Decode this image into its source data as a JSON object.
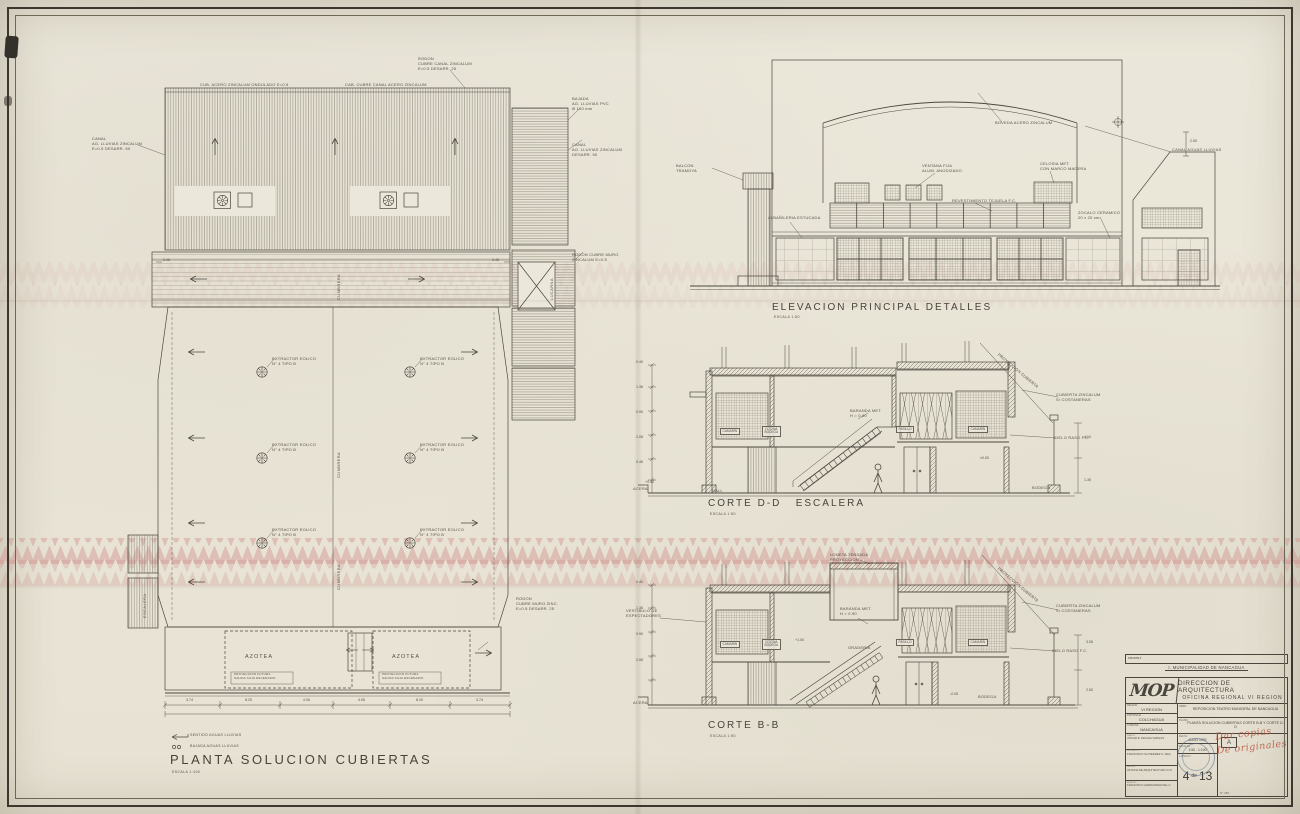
{
  "sheet": {
    "paper": "#eae6d8",
    "ink": "#4c473e",
    "pink": "#cf8d8a",
    "red": "#b5543e"
  },
  "plan": {
    "title": "PLANTA SOLUCION CUBIERTAS",
    "scale": "ESCALA 1:100",
    "legend": [
      {
        "label": "SENTIDO AGUAS LLUVIAS"
      },
      {
        "label": "BAJADA AGUAS LLUVIAS"
      }
    ],
    "notes": {
      "ridge_l": "CUB. ACERO ZINCALUM ONDULADO E=0.5",
      "ridge_r": "CAB. CUBRE CANAL ACERO ZINCALUM",
      "canal_tr": "RODON\nCUBRE CANAL ZINCALUM\nE=0.5 DESARR. 25",
      "canal_l": "CANAL\nAG. LLUVIAS ZINCALUM\nE=0.5 DESARR. 50",
      "canal_r1": "BAJADA\nAG. LLUVIAS PVC\nØ 100 mm",
      "canal_r2": "CANAL\nAG. LLUVIAS ZINCALUM\nDESARR. 50",
      "canal_r3": "RODON CUBRE MURO\nZINCALUM E=0.5",
      "rodon_b": "RODON\nCUBRE MURO ZINC.\nE=0.5 DESARR. 25"
    },
    "vent_note": "EXTRACTOR EOLICO\nN° 4  TIPO B",
    "vertical_ridge": "CUMBRERA",
    "escalera": "ESCALERA",
    "lucarna": "LUCARNA",
    "azotea": "AZOTEA",
    "azotea_note": "PROYECCION FUTURA\nSALIDA CAJA ESCENARIO",
    "dims_band": [
      "2.46",
      "2.46"
    ],
    "dims_bottom": [
      "3.74",
      "8.20",
      "4.06",
      "4.06",
      "8.20",
      "3.74"
    ]
  },
  "elevation": {
    "title": "ELEVACION PRINCIPAL DETALLES",
    "scale": "ESCALA 1:50",
    "callouts": [
      "BOVEDA ACERO ZINCALUM",
      "CANAL AGUAS LLUVIAS",
      "VENTANA FIJA\nALUM. ANODIZADO",
      "CELOSIA MET.\nCON MARCO MADERA",
      "REVESTIMIENTO TEJUELA F.C.",
      "BALCON\nTRAMOYA",
      "ALBAÑILERIA ESTUCADA",
      "ZOCALO CERAMICO\n20 x 20 cm"
    ],
    "dim": "2.50"
  },
  "corte_dd": {
    "title": "CORTE D-D   ESCALERA",
    "scale": "ESCALA 1:50",
    "acera": "ACERA",
    "hall": "HALL",
    "rooms": [
      "CAMARIN",
      "COCINA\nBODEGA",
      "PASILLO",
      "CAMARIN"
    ],
    "bodega": "BODEGA",
    "baranda": "BARANDA MET.\nH = 0.90",
    "cub1": "CUBIERTA ZINCALUM\nS/ COSTANERAS",
    "cub2": "CIELO RASO F.C.",
    "slope": "PROYECCION CUBIERTA",
    "levels": {
      "l00": "±0.00",
      "l12": "+0.12"
    },
    "left_dims": [
      "0.40",
      "1.36",
      "0.90",
      "2.08",
      "0.46"
    ],
    "right_dims": [
      "4.10",
      "1.35"
    ]
  },
  "corte_bb": {
    "title": "CORTE B-B",
    "scale": "ESCALA 1:50",
    "loneta": "LONETA TENSADA\nPROYECCION",
    "vestibulo": "VESTIBULO DE\nESPECTADORES",
    "baranda": "BARANDA MET.\nH = 0.90",
    "graderia": "GRADERIA",
    "rooms": [
      "CAMARIN",
      "COCINA\nBODEGA",
      "PASILLO",
      "CAMARIN"
    ],
    "plus1": "+1.00",
    "bodega": "BODEGA",
    "lm05": "-0.05",
    "acera": "ACERA",
    "cub1": "CUBIERTA ZINCALUM\nS/ COSTANERAS",
    "cub2": "CIELO RASO F.C.",
    "slope": "PROYECCION CUBIERTA",
    "left_dims": [
      "0.40",
      "1.36",
      "0.90",
      "2.08"
    ],
    "right_dims": [
      "3.06",
      "2.50"
    ]
  },
  "titleblock": {
    "propietario_label": "PROPIET.",
    "propietario": "I. MUNICIPALIDAD DE NANCAGUA",
    "logo": "MOP",
    "dept1": "DIRECCION DE ARQUITECTURA",
    "dept2": "OFICINA REGIONAL VI REGION",
    "region_label": "REGION",
    "region": "VI REGION",
    "provincia_label": "PROVINCIA",
    "provincia": "COLCHAGUA",
    "comuna_label": "COMUNA",
    "comuna": "NANCAGUA",
    "obra_label": "OBRA",
    "obra": "REPOSICION TEATRO MUNICIPAL DE NANCAGUA",
    "plano_label": "PLANO",
    "plano": "PLANTA SOLUCION CUBIERTAS CORTE B-B Y CORTE D-D",
    "firmas": [
      {
        "label": "DIBUJO",
        "name": "OSCAR E. MOLINA VARGAS"
      },
      {
        "label": "PROYECTO",
        "name": "FRANCISCO GUTIERREZ S. ARQ."
      },
      {
        "label": "REVISO",
        "name": "OFICINA DE ARQUITECTURA VI R."
      },
      {
        "label": "APROBO",
        "name": "FRANCISCO HERNANDEZ DEL C."
      }
    ],
    "fecha_label": "FECHA",
    "fecha": "JULIO 1992",
    "escalas_label": "ESCALAS",
    "escalas": "1:50 - 1:100",
    "lamina_label": "LAMINA N°",
    "rev_label": "REV.",
    "revision": "A",
    "sheet_num": "4",
    "sheet_of": "de",
    "sheet_total": "13",
    "archivo": "N° 287",
    "handwriting": "Dar copias\nDe originales"
  }
}
